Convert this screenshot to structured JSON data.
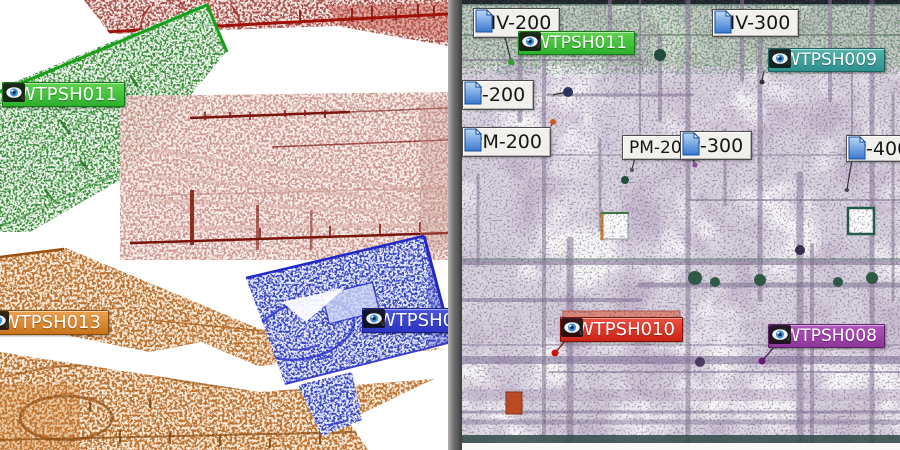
{
  "app": {
    "view": "point-cloud scan registration, dual viewport",
    "left_view": "unregistered scans plan view",
    "right_view": "registered site scan view"
  },
  "left": {
    "scan_labels": [
      {
        "text": "*WTPSH011",
        "color": "green",
        "color_hex": "#2db02d",
        "icon": "eye-icon"
      },
      {
        "text": "*WTPSH013",
        "color": "orange",
        "color_hex": "#c8731c",
        "icon": "eye-icon",
        "note": "left edge clipped by viewport"
      },
      {
        "text": "*WTPSH012",
        "color": "blue",
        "color_hex": "#2c35c2",
        "icon": "eye-icon",
        "note": "right edge clipped by divider"
      }
    ]
  },
  "right": {
    "scan_labels": [
      {
        "text": "*WTPSH011",
        "color": "green",
        "color_hex": "#2db02d",
        "icon": "eye-icon"
      },
      {
        "text": "*WTPSH009",
        "color": "teal",
        "color_hex": "#2e8f8c",
        "icon": "eye-icon"
      },
      {
        "text": "*WTPSH010",
        "color": "red",
        "color_hex": "#c92315",
        "icon": "eye-icon"
      },
      {
        "text": "*WTPSH008",
        "color": "purple",
        "color_hex": "#8d3598",
        "icon": "eye-icon"
      }
    ],
    "tag_labels": [
      {
        "text": "HV-200",
        "icon": "page-icon"
      },
      {
        "text": "HV-300",
        "icon": "page-icon"
      },
      {
        "text": "P-200",
        "icon": "page-icon"
      },
      {
        "text": "PM-200",
        "icon": "page-icon"
      },
      {
        "text": "PM-200",
        "icon": "none"
      },
      {
        "text": "P-300",
        "icon": "page-icon"
      },
      {
        "text": "P-400",
        "icon": "page-icon",
        "note": "right edge clipped by viewport"
      }
    ]
  },
  "colors": {
    "tag_background": "#f1f0ed",
    "tag_icon_blue": "#3678d0",
    "divider_gray": "#787878",
    "eye_iris_blue": "#3d8fd6",
    "right_base_lavender": "#d8d2de",
    "right_top_green": "#a8c8a0",
    "salmon_pipe": "#de8a7a"
  }
}
